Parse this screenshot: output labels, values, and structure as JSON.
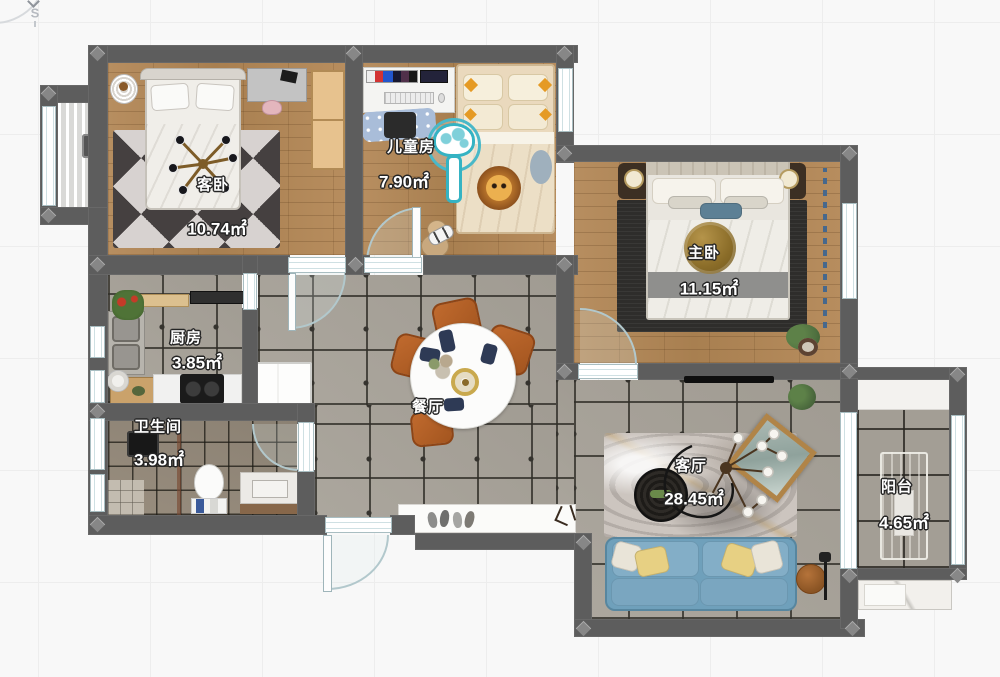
{
  "compass": {
    "south_label": "S"
  },
  "rooms": {
    "guest_bedroom": {
      "name": "客卧",
      "area": "10.74㎡"
    },
    "kids_room": {
      "name": "儿童房",
      "area": "7.90㎡"
    },
    "master_bedroom": {
      "name": "主卧",
      "area": "11.15㎡"
    },
    "kitchen": {
      "name": "厨房",
      "area": "3.85㎡"
    },
    "bathroom": {
      "name": "卫生间",
      "area": "3.98㎡"
    },
    "dining_room": {
      "name": "餐厅"
    },
    "living_room": {
      "name": "客厅",
      "area": "28.45㎡"
    },
    "balcony": {
      "name": "阳台",
      "area": "4.65㎡"
    }
  },
  "palette": {
    "wall": "#5d5d5d",
    "wood_floor": "#b1895a",
    "gray_tile": "#a8a39a",
    "bath_tile": "#94897a",
    "sofa_blue": "#6fa0bb",
    "dining_chair_brown": "#b0612a",
    "mushroom_teal": "#35b3c3",
    "gold_light": "#8a6c28"
  }
}
